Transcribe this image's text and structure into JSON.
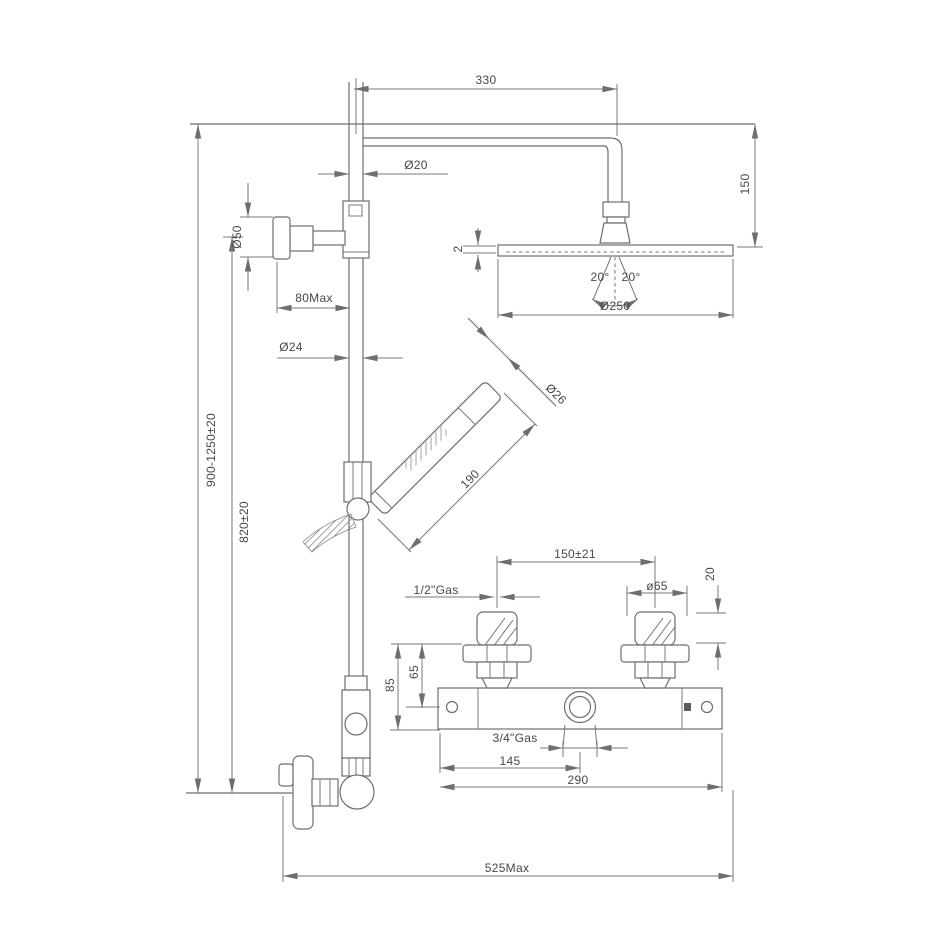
{
  "drawing_title": "thermostatic-shower-system-dimension-diagram",
  "colors": {
    "line": "#6e6e6e",
    "text": "#474747",
    "background": "#ffffff"
  },
  "dims": {
    "top_width": "330",
    "arm_pipe_dia": "Ø20",
    "knob_dia": "Ø50",
    "knob_depth": "80Max",
    "head_thickness": "2",
    "drop_height": "150",
    "spray_angle_left": "20°",
    "spray_angle_right": "20°",
    "head_dia": "Ø250",
    "riser_dia": "Ø24",
    "handset_dia": "Ø26",
    "handset_length": "190",
    "overall_height": "900-1250±20",
    "riser_height": "820±20",
    "valve_centers": "150±21",
    "inlet_thread": "1/2\"Gas",
    "handle_dia": "ø65",
    "handle_offset": "20",
    "valve_height_total": "85",
    "valve_height_center": "65",
    "outlet_thread": "3/4\"Gas",
    "outlet_offset": "145",
    "valve_width": "290",
    "max_width": "525Max"
  }
}
